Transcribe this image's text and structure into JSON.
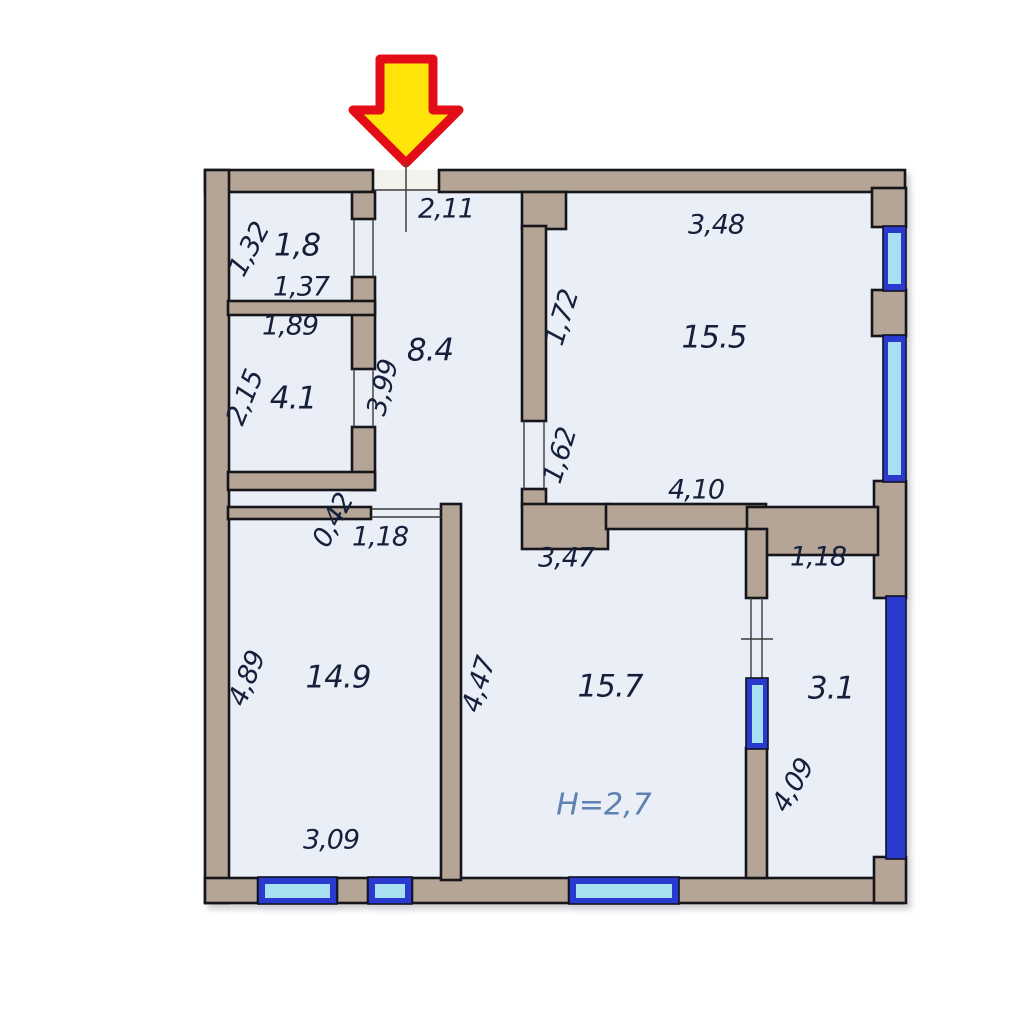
{
  "colors": {
    "wall": "#b4a597",
    "outline": "#15151a",
    "floor": "#e9eef7",
    "gap": "#f3f2ed",
    "window_frame": "#2a3ace",
    "window_glass": "#a8e0f2",
    "arrow_fill": "#ffe409",
    "arrow_stroke": "#e30d17",
    "text": "#16203a",
    "height_text": "#5e81b0"
  },
  "rooms": {
    "r84": {
      "area": "8.4",
      "dim_top": "2,11",
      "dim_left": "3,99"
    },
    "r18": {
      "area": "1,8",
      "dim_left": "1,32",
      "dim_bottom": "1,37"
    },
    "r41": {
      "area": "4.1",
      "dim_top": "1,89",
      "dim_left": "2,15"
    },
    "r155": {
      "area": "15.5",
      "dim_top": "3,48",
      "dim_left": "1,72",
      "dim_door": "1,62",
      "dim_bottom": "4,10"
    },
    "r149": {
      "area": "14.9",
      "dim_niche": "0,42",
      "dim_door": "1,18",
      "dim_left": "4,89",
      "dim_bottom": "3,09"
    },
    "r157": {
      "area": "15.7",
      "dim_top": "3,47",
      "dim_left": "4,47",
      "ceiling_height": "H=2,7"
    },
    "r31": {
      "area": "3.1",
      "dim_top": "1,18",
      "dim_left": "4,09"
    }
  }
}
